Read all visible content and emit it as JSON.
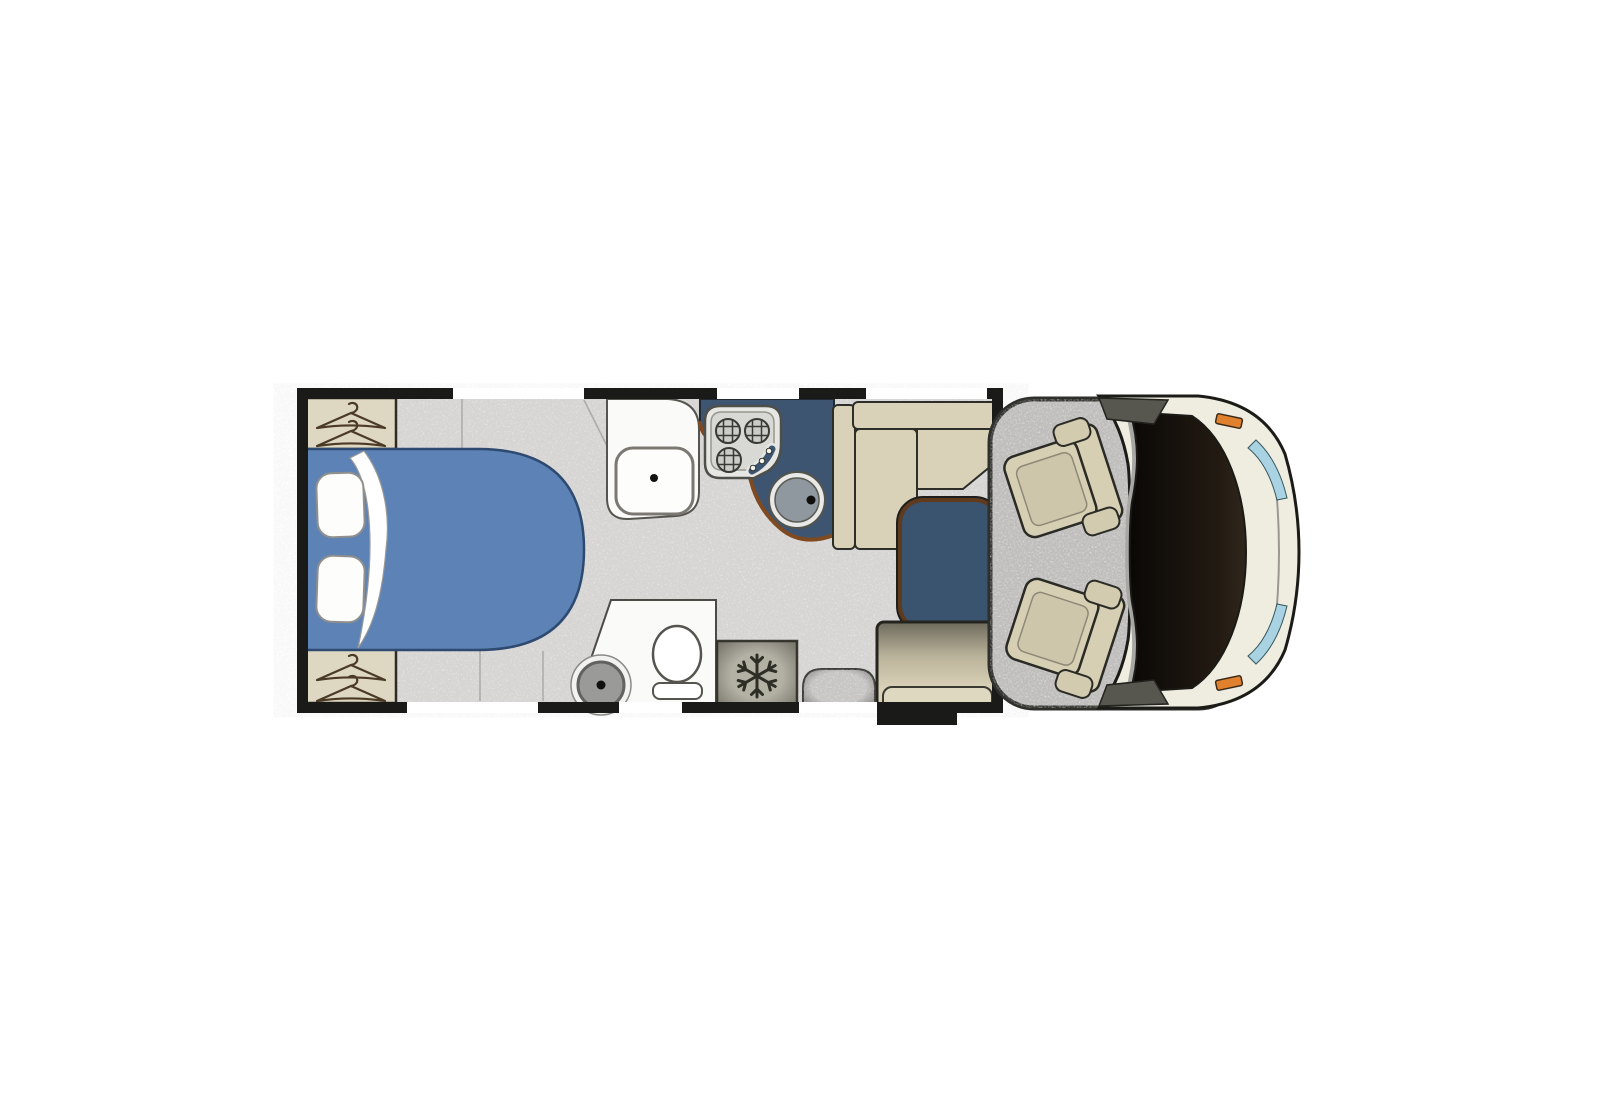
{
  "meta": {
    "title": "motorhome-floorplan-top-view",
    "type": "vehicle-floor-plan"
  },
  "colors": {
    "background": "#ffffff",
    "wall": "#1a1a18",
    "window": "#ffffff",
    "floor": "#d7d6d4",
    "floor_seam": "#aeadab",
    "cab_floor": "#bebdbb",
    "step": "#c7c6c4",
    "bed": "#5d83b6",
    "bed_edge": "#2e4a70",
    "pillow": "#fdfdfc",
    "sheet": "#ffffff",
    "wardrobe": "#ded7c2",
    "hanger": "#4a3a26",
    "bath": "#fafaf8",
    "fixture_ring": "#9a9a98",
    "counter": "#3d5571",
    "counter_trim": "#804a20",
    "hob": "#e6e6e2",
    "hob_panel": "#d8d8d4",
    "burner": "#cbcbc7",
    "sink": "#8f979f",
    "fridge": "#b3b0a4",
    "fridge_icon": "#2e2e26",
    "bench": "#d9d2b8",
    "bench_edge": "#2e2e28",
    "bench_pad": "#ded8c0",
    "table": "#3a536f",
    "table_rim": "#5f3a1c",
    "seat": "#d6cfb4",
    "seat_inner": "#cdc6aa",
    "body": "#efece0",
    "body_rim": "#a8a7a3",
    "pillar": "#57574f",
    "windshield_dark": "#0a0806",
    "windshield_light": "#30261c",
    "indicator": "#e0812f",
    "headlight": "#a9d2e2"
  },
  "icons": {
    "hanger": "hanger-icon",
    "snowflake": "snowflake-icon",
    "burner": "hob-burner-icon",
    "drain": "drain-dot-icon"
  },
  "areas": {
    "bedroom": [
      "wardrobe-top",
      "double-bed",
      "pillow",
      "pillow",
      "wardrobe-bottom"
    ],
    "washroom": [
      "washbasin",
      "shower",
      "toilet"
    ],
    "kitchen": [
      "hob",
      "sink",
      "fridge"
    ],
    "dinette": [
      "l-bench",
      "table",
      "travel-seat",
      "entry-step"
    ],
    "cab": [
      "swivel-seat-left",
      "swivel-seat-right",
      "windshield",
      "bonnet"
    ]
  },
  "openings": {
    "top_windows": 3,
    "bottom_windows": 2,
    "entry_door": 1
  }
}
